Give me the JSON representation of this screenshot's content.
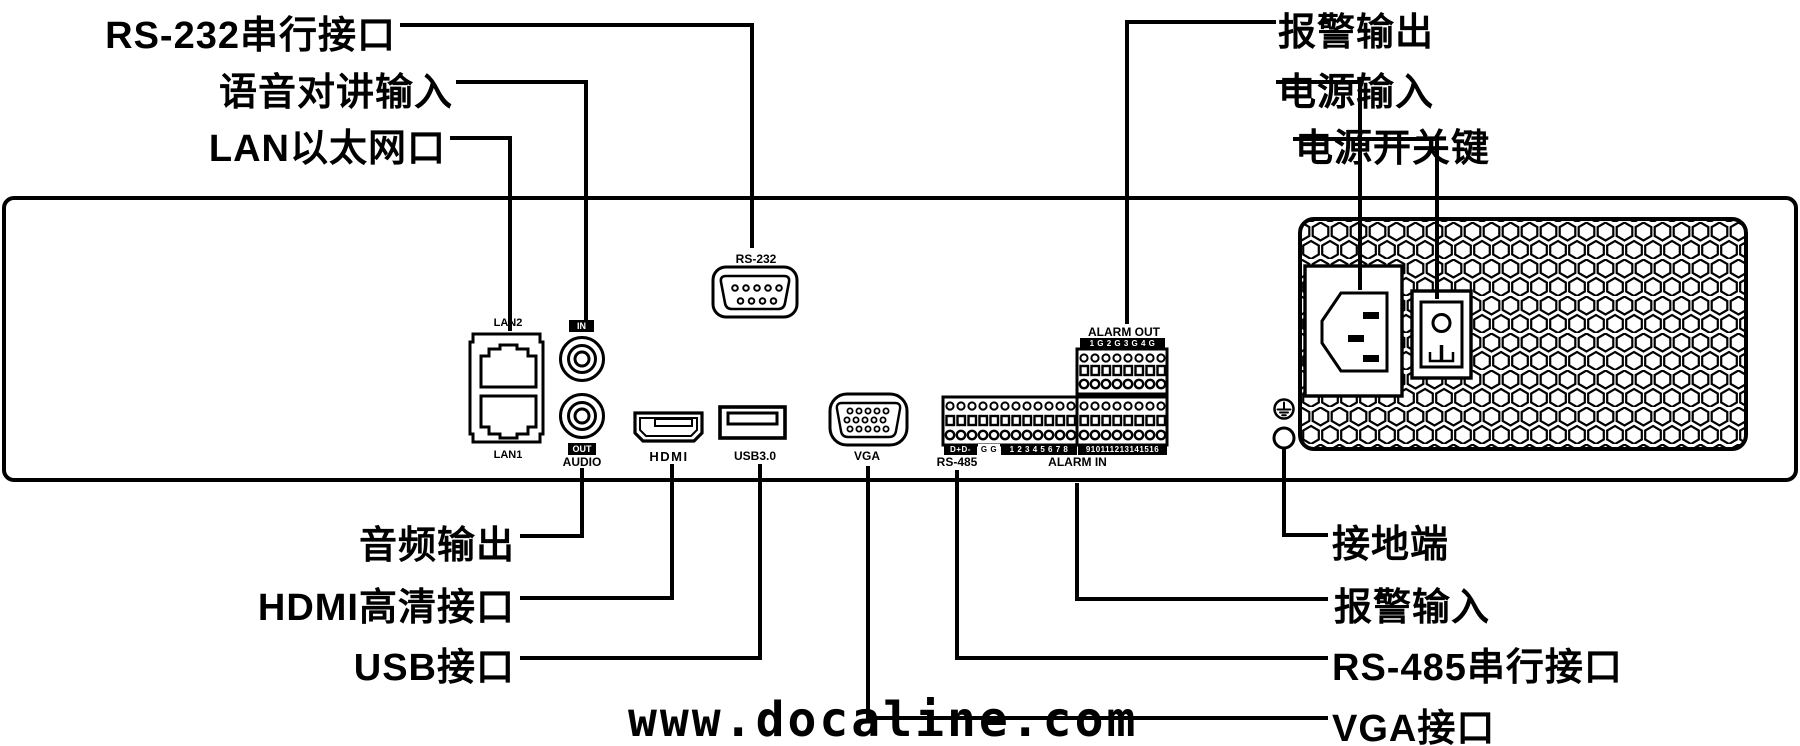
{
  "diagram_title": "NVR/DVR rear panel interface diagram",
  "callouts": {
    "rs232": "RS-232串行接口",
    "audio_in": "语音对讲输入",
    "lan": "LAN以太网口",
    "alarm_out": "报警输出",
    "power_in": "电源输入",
    "power_switch": "电源开关键",
    "audio_out": "音频输出",
    "hdmi": "HDMI高清接口",
    "usb": "USB接口",
    "ground": "接地端",
    "alarm_in": "报警输入",
    "rs485": "RS-485串行接口",
    "vga": "VGA接口"
  },
  "port_labels": {
    "lan2": "LAN2",
    "lan1": "LAN1",
    "audio_in_tag": "IN",
    "audio_out_tag": "OUT",
    "audio": "AUDIO",
    "rs232": "RS-232",
    "hdmi": "HDMI",
    "usb": "USB3.0",
    "vga": "VGA",
    "alarm_out_title": "ALARM OUT",
    "alarm_out_pins": "1 G 2 G 3 G 4 G",
    "rs485_pins": "D+D-",
    "rs485_gnd_pins": "G G",
    "alarm_in_pins_1_8": "1 2 3 4 5 6 7 8",
    "alarm_in_pins_9_16": "910111213141516",
    "rs485": "RS-485",
    "alarm_in": "ALARM IN"
  },
  "watermark": "www.docaline.com",
  "colors": {
    "ink": "#000000",
    "background": "#ffffff"
  }
}
